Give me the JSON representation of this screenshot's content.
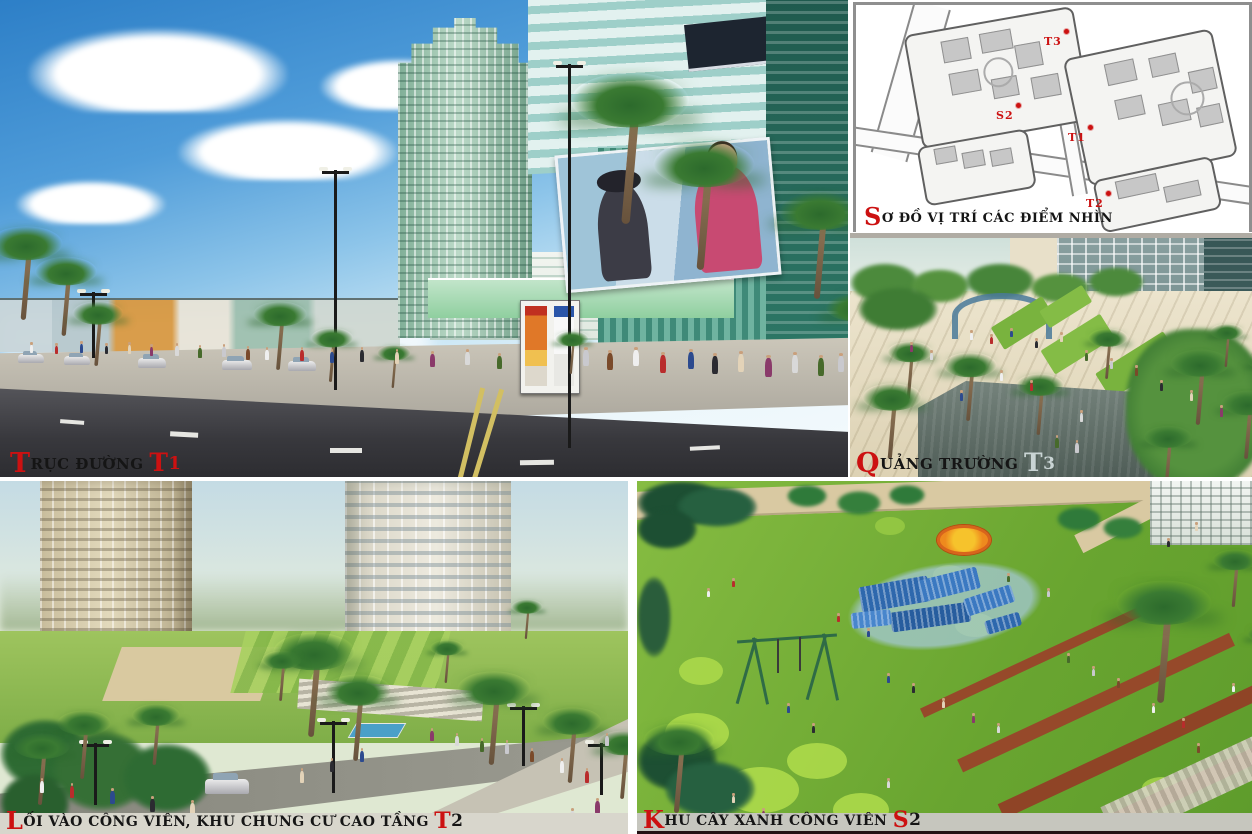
{
  "panels": {
    "t1": {
      "caption": {
        "lead": "T",
        "body": "RỤC ĐƯỜNG ",
        "tag_lead": "T",
        "tag_rest": "1"
      }
    },
    "plan": {
      "caption": {
        "lead": "S",
        "body": "Ơ ĐỒ VỊ TRÍ CÁC ĐIỂM NHÌN"
      },
      "markers": [
        {
          "label": "T3"
        },
        {
          "label": "S2"
        },
        {
          "label": "T1"
        },
        {
          "label": "T2"
        }
      ]
    },
    "t3": {
      "caption": {
        "lead": "Q",
        "body": "UẢNG TRƯỜNG ",
        "tag_lead": "T",
        "tag_rest": "3"
      }
    },
    "t2": {
      "caption": {
        "lead": "L",
        "body": "ỐI VÀO CÔNG VIÊN, KHU CHUNG CƯ CAO TẦNG ",
        "tag_lead": "T",
        "tag_rest": "2"
      }
    },
    "s2": {
      "caption": {
        "lead": "K",
        "body": "HU CÂY XANH CÔNG VIÊN ",
        "tag_lead": "S",
        "tag_rest": "2"
      }
    }
  },
  "colors": {
    "accent_red": "#cc1111",
    "caption_text": "#151515",
    "t3_tag_gray": "#c9d4d4",
    "t2_band_gray": "#d8d6cc",
    "s2_band_gray": "#c6c6be"
  }
}
